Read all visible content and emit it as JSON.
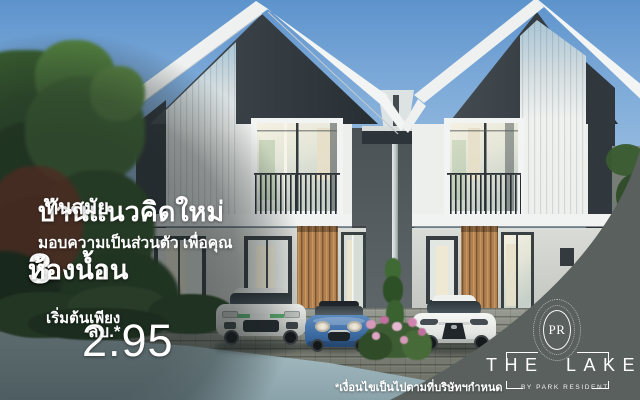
{
  "meta": {
    "kind": "real-estate-ad-banner",
    "language": "th"
  },
  "headline": {
    "line1_main": "บ้านแนวคิดใหม่",
    "line1_suffix": "ทันสมัย",
    "line2": "มอบความเป็นส่วนตัว เพื่อคุณ"
  },
  "features": {
    "bedrooms_count": "3",
    "bedrooms_label": "ห้องนอน",
    "bathrooms_count": "3",
    "bathrooms_label": "ห้องน้ำ"
  },
  "price": {
    "prefix": "เริ่มต้นเพียง",
    "value": "2.95",
    "unit": "ลบ.*"
  },
  "brand": {
    "monogram": "PR",
    "project_name": "THE LAKE",
    "byline": "BY PARK RESIDENT"
  },
  "disclaimer": "*เงื่อนไขเป็นไปตามที่บริษัทฯกำหนด",
  "colors": {
    "panel": "#59605e",
    "sky_top": "#5d93cc",
    "wood_slat": "#b08050",
    "car_blue": "#3c6ba2",
    "text": "#ffffff"
  }
}
